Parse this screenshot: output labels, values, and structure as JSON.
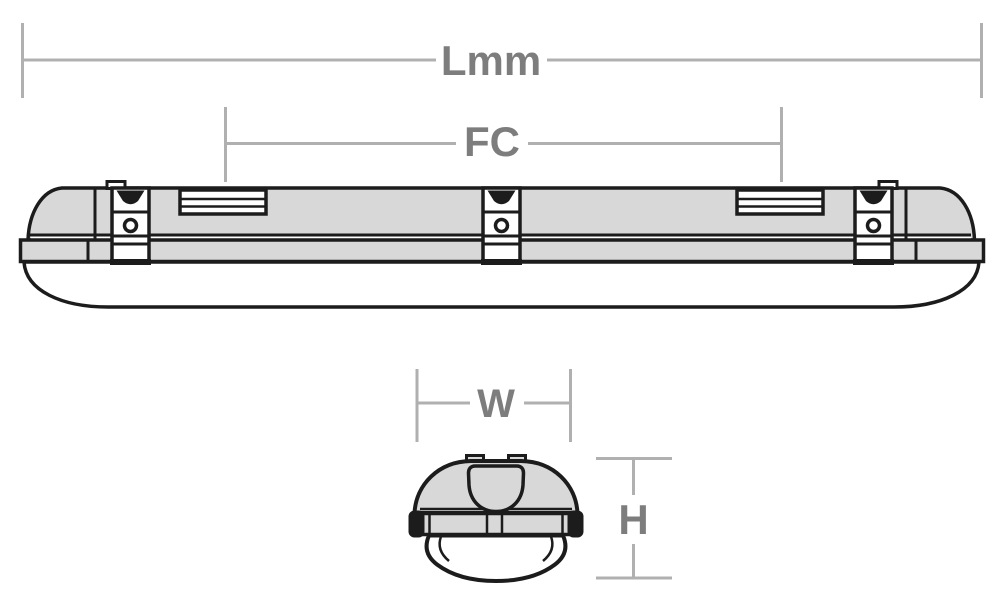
{
  "diagram": {
    "labels": {
      "length": "Lmm",
      "fixing_centres": "FC",
      "width": "W",
      "height": "H"
    },
    "colors": {
      "dimension_line": "#b0b0b0",
      "dimension_text": "#7d7d7d",
      "outline": "#1c1c1c",
      "body_fill": "#d8d8d8",
      "diffuser_fill": "#ffffff",
      "background": "#ffffff"
    },
    "figure": {
      "side_view_mounting_clips": 3,
      "side_view_vent_slots": 2,
      "end_view_top_tabs": 2
    }
  }
}
